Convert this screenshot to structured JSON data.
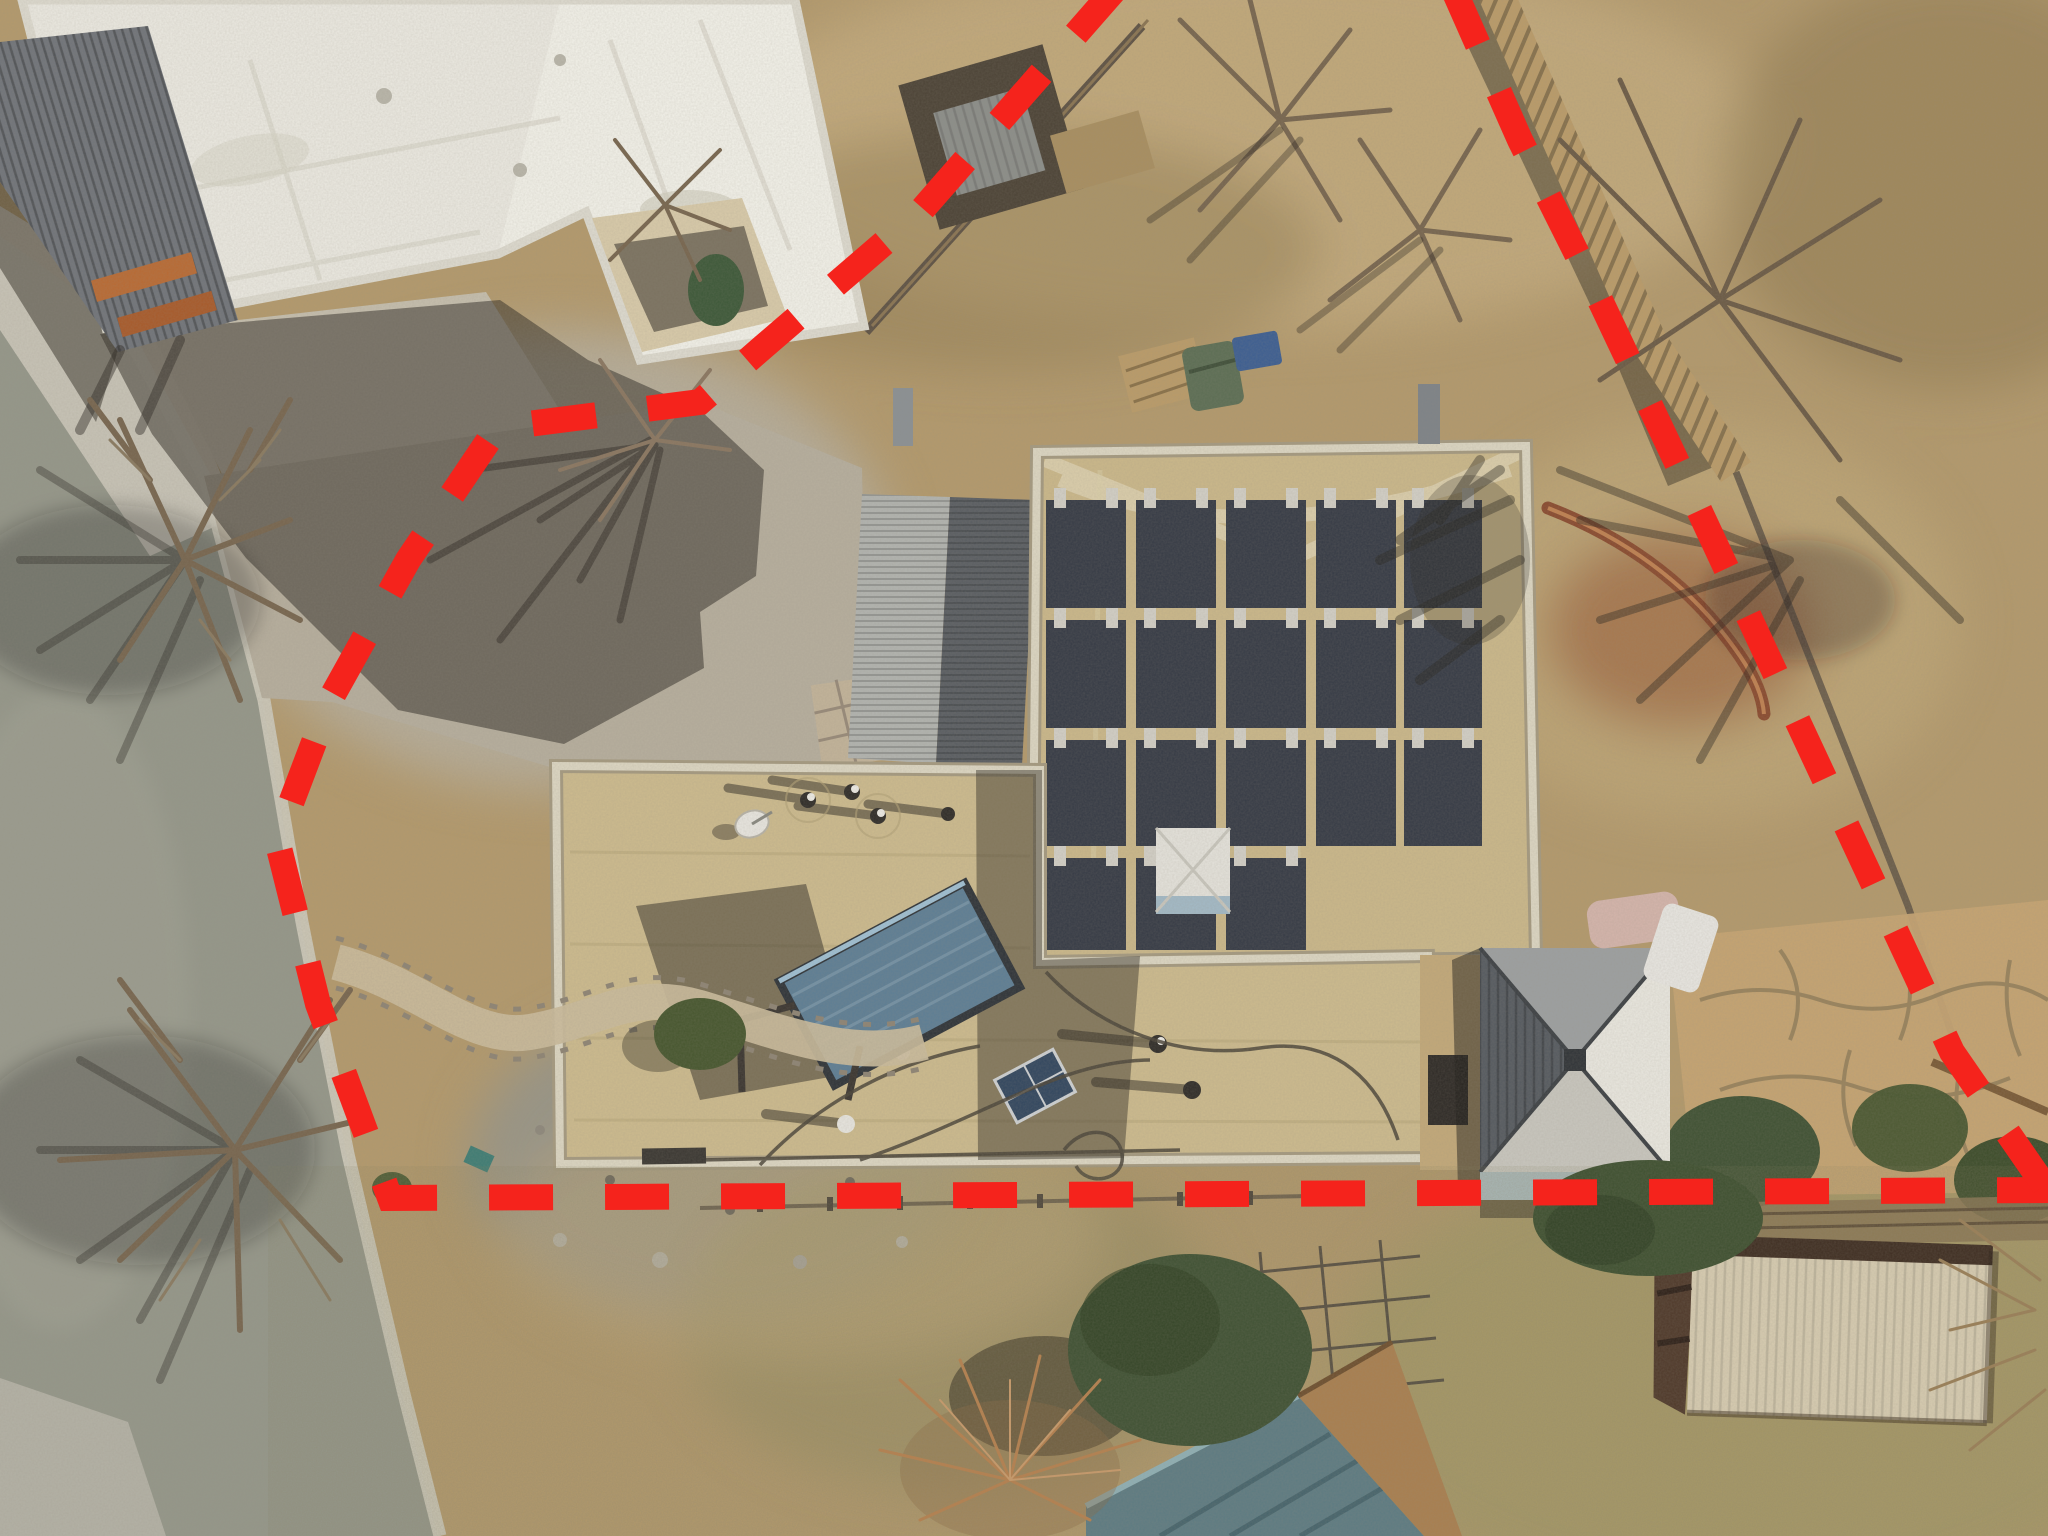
{
  "scene": {
    "kind": "aerial-drone-photograph",
    "subject": "overhead view of a residential property with flat tan roofs, rooftop solar panel array, solar water heater, metal gazebo, sheds, gravel driveway and curving street",
    "overlay": "red dashed property boundary lines"
  },
  "boundary": {
    "color": "#f5231c",
    "width": 26,
    "dash": "64 52",
    "west_points": "1118,-14 920,212 762,348 700,402 497,428 408,560 330,700 277,840 318,1004 390,1198 2060,1190",
    "east_points": "1452,-14 1520,140 1600,300 1672,452 1742,602 1812,752 1882,902 1952,1052 2046,1188"
  },
  "palette": {
    "dirt": "#b49a6c",
    "dirt_light": "#c6ad7e",
    "dirt_red": "#a06a44",
    "grass": "#a79a66",
    "gravel": "#b7af9e",
    "gravel_blue": "#96958a",
    "road": "#95978a",
    "concrete": "#cdc9bb",
    "white_roof": "#eceae2",
    "white_roof_lit": "#f7f5ee",
    "wall_cream": "#d9cbaa",
    "carport_gray": "#70747a",
    "beam_orange": "#b96a33",
    "corr_light": "#b2b4b0",
    "corr_dark": "#595d62",
    "roof_tan": "#cbb88a",
    "roof_tan_low": "#cdbb8e",
    "parapet": "#ddd7c3",
    "heater_blue": "#5d7e95",
    "skylight": "#e5e3dc",
    "skylight_blue": "#a3bac7",
    "gazebo_dark": "#555a60",
    "gazebo_mid": "#9da0a1",
    "gazebo_light": "#eae8e0",
    "gazebo_blue": "#aabfc9",
    "shed_roof": "#d7ccb1",
    "shed_wall": "#4f392a",
    "teal_roof": "#5d7b82",
    "tree_green": "#46552f",
    "juniper": "#3f5133",
    "stone": "#c6a472",
    "bin_green": "#5c6e54",
    "bin_blue": "#3c5e92",
    "fence_wood": "#bb9c69",
    "fence_dark": "#5e5244"
  },
  "solar_array": {
    "panel_color": "#353a45",
    "bracket_color": "#d3d0c7",
    "cells": [
      {
        "x": 1046,
        "y": 500,
        "w": 80,
        "h": 108
      },
      {
        "x": 1046,
        "y": 620,
        "w": 80,
        "h": 108
      },
      {
        "x": 1046,
        "y": 740,
        "w": 80,
        "h": 106
      },
      {
        "x": 1046,
        "y": 858,
        "w": 80,
        "h": 92
      },
      {
        "x": 1136,
        "y": 500,
        "w": 80,
        "h": 108
      },
      {
        "x": 1136,
        "y": 620,
        "w": 80,
        "h": 108
      },
      {
        "x": 1136,
        "y": 740,
        "w": 80,
        "h": 106
      },
      {
        "x": 1136,
        "y": 858,
        "w": 80,
        "h": 92
      },
      {
        "x": 1226,
        "y": 500,
        "w": 80,
        "h": 108
      },
      {
        "x": 1226,
        "y": 620,
        "w": 80,
        "h": 108
      },
      {
        "x": 1226,
        "y": 740,
        "w": 80,
        "h": 106
      },
      {
        "x": 1226,
        "y": 858,
        "w": 80,
        "h": 92
      },
      {
        "x": 1316,
        "y": 500,
        "w": 80,
        "h": 108
      },
      {
        "x": 1316,
        "y": 620,
        "w": 80,
        "h": 108
      },
      {
        "x": 1316,
        "y": 740,
        "w": 80,
        "h": 106
      },
      {
        "x": 1404,
        "y": 500,
        "w": 78,
        "h": 108
      },
      {
        "x": 1404,
        "y": 620,
        "w": 78,
        "h": 108
      },
      {
        "x": 1404,
        "y": 740,
        "w": 78,
        "h": 106
      }
    ]
  },
  "features": [
    "red dashed property boundary",
    "main house flat tan roof",
    "rooftop solar panel array",
    "pitched corrugated metal roof section",
    "solar water heater on roof",
    "rooftop skylight",
    "rooftop vent pipes with shadows",
    "satellite dish",
    "metal hip-roof gazebo",
    "flagstone patio and bushes",
    "neighbor white flat-roof house",
    "metal carport awning with wood beams",
    "asphalt street with concrete curb",
    "gravel driveway",
    "bare winter trees with shadows",
    "green and blue trash bins",
    "wood back fence",
    "storage shed with cream metal roof",
    "teal metal roof cottage",
    "juniper tree and dry shrub",
    "wire garden fence"
  ]
}
